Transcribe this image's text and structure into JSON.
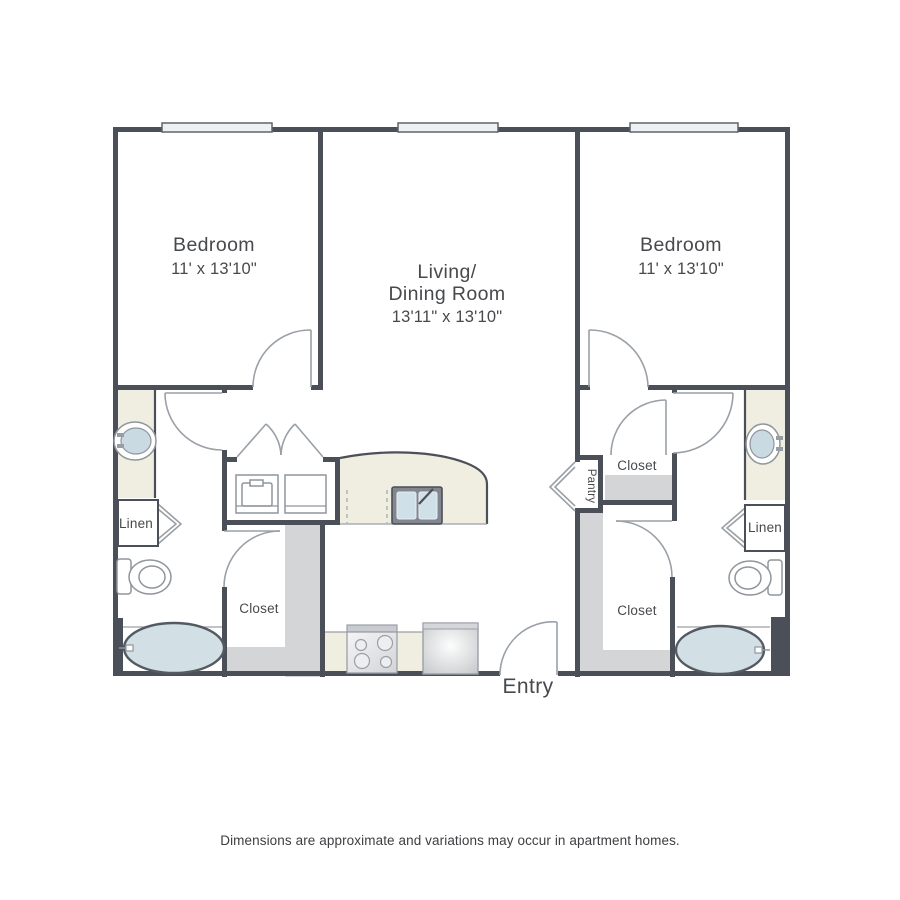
{
  "floorplan": {
    "rooms": {
      "bedroom_left": {
        "label": "Bedroom",
        "dims": "11' x 13'10\""
      },
      "bedroom_right": {
        "label": "Bedroom",
        "dims": "11' x 13'10\""
      },
      "living_dining": {
        "label_line1": "Living/",
        "label_line2": "Dining Room",
        "dims": "13'11\" x 13'10\""
      }
    },
    "labels": {
      "closet_left": "Closet",
      "closet_right_upper": "Closet",
      "closet_right_lower": "Closet",
      "linen_left": "Linen",
      "linen_right": "Linen",
      "pantry": "Pantry",
      "entry": "Entry"
    },
    "fixtures": [
      "bathtub-left",
      "bathtub-right",
      "toilet-left",
      "toilet-right",
      "bath-sink-left",
      "bath-sink-right",
      "kitchen-sink",
      "dishwasher-dashes",
      "stove",
      "refrigerator",
      "washer",
      "dryer"
    ],
    "window_count": 3,
    "colors": {
      "wall": "#4b4f58",
      "counter_beige": "#f0eee0",
      "closet_floor": "#d3d5d7",
      "fixture_blue": "#d2dfe5",
      "line_gray": "#9aa0a7",
      "window_fill": "#eef1f3",
      "text": "#47494c"
    },
    "disclaimer": "Dimensions are approximate and variations may occur in apartment homes."
  }
}
